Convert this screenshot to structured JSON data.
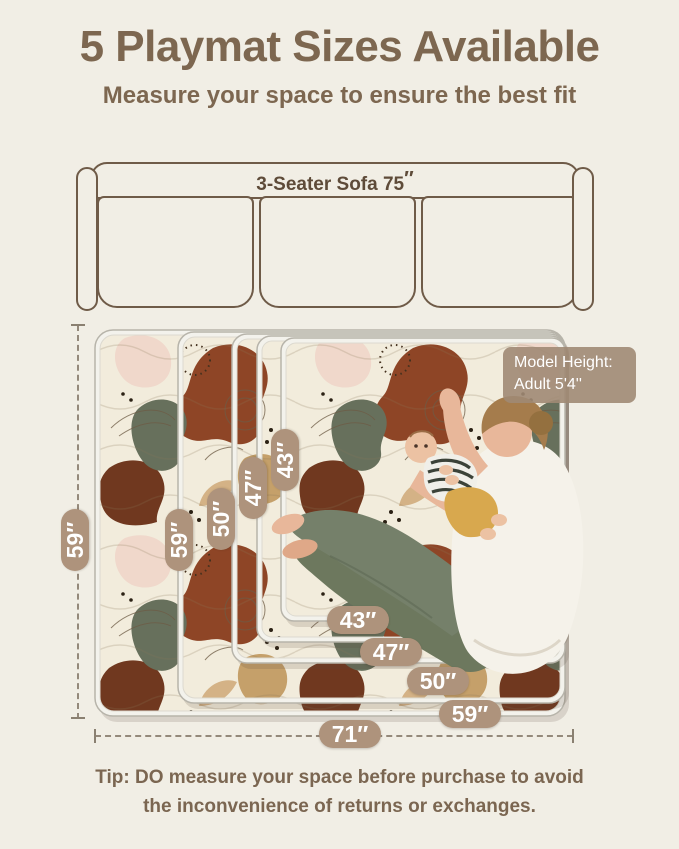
{
  "header": {
    "title": "5 Playmat Sizes Available",
    "subtitle": "Measure your space to ensure the best fit"
  },
  "sofa": {
    "label": "3-Seater Sofa 75",
    "unit": "″",
    "seat_count": 3
  },
  "model_badge": {
    "line1": "Model Height:",
    "line2": "Adult  5'4''"
  },
  "size_badges": {
    "vertical": [
      "59″",
      "50″",
      "47″",
      "43″"
    ],
    "horizontal": [
      "43″",
      "47″",
      "50″",
      "59″"
    ]
  },
  "overall": {
    "height": "59″",
    "width": "71″"
  },
  "tip": {
    "line1": "Tip: DO measure your space before purchase to avoid",
    "line2": "the inconvenience of returns or exchanges."
  },
  "colors": {
    "background": "#f1eee5",
    "accent_brown": "#7d6750",
    "badge_tan": "#ae937c",
    "sofa_outline": "#6f5b48",
    "mat_rust": "#8e4526",
    "mat_olive": "#67705c",
    "mat_tan": "#c5a06a",
    "mat_pink": "#f0d8cb",
    "mat_cream": "#f2ecdc"
  }
}
